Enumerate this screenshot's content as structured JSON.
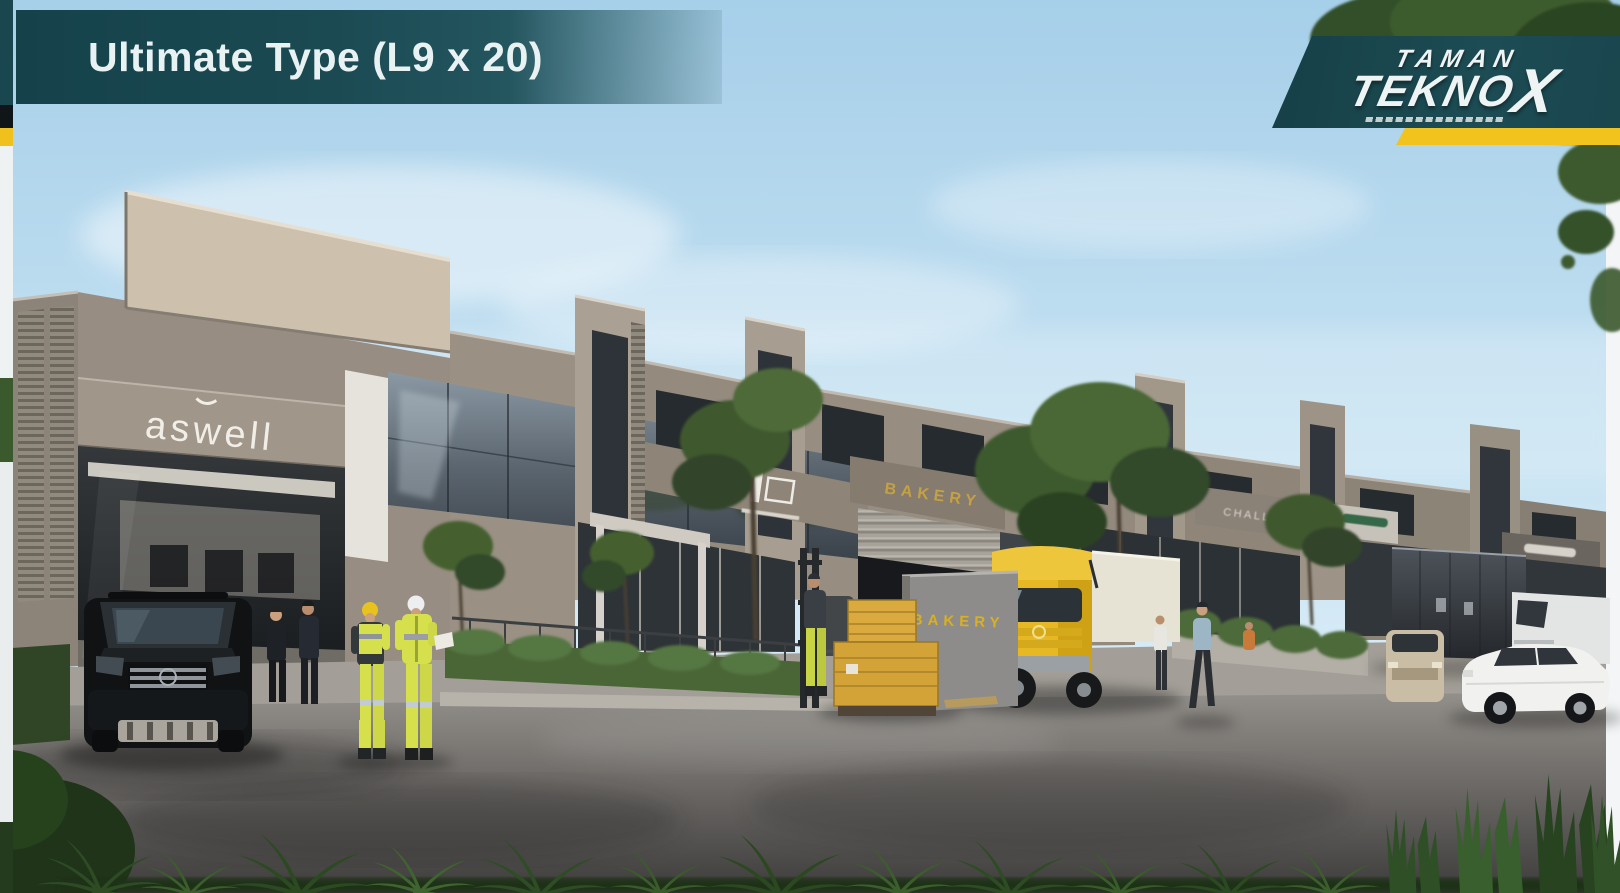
{
  "slide": {
    "title": "Ultimate Type (L9 x 20)"
  },
  "brand": {
    "name_line1": "TAMAN",
    "name_line2_main": "TEKNO",
    "name_line2_x": "X"
  },
  "signs": {
    "unit1_fascia": "aswell",
    "unit3_fascia": "BAKERY",
    "unit3_wall": "BAKERY",
    "unit4_fascia": "CHALLDEN"
  },
  "palette": {
    "banner_teal": "#1b4a53",
    "logo_teal": "#1d4c54",
    "brand_yellow": "#f2c31d",
    "sky_top": "#a6cfe9",
    "sky_bottom": "#e9f4fa",
    "building_taupe": "#978d82",
    "building_cream": "#cdc1ae",
    "glass_dark": "#49525a",
    "road_asphalt": "#4a4846",
    "foliage_green": "#3b5e2c",
    "hivis_yellow": "#d6e04c",
    "truck_yellow": "#e5b824",
    "sign_gold": "#c5a143"
  }
}
